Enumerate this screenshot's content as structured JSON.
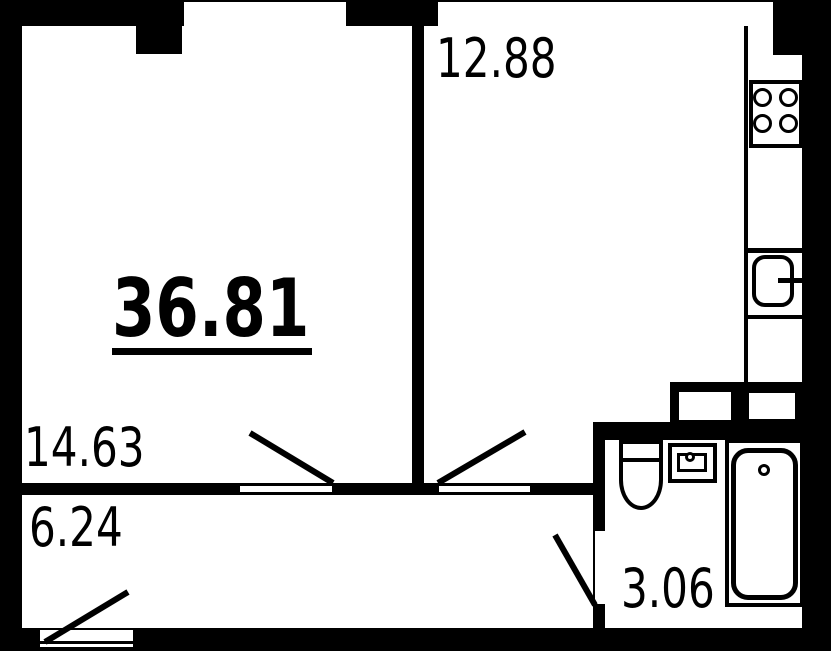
{
  "plan": {
    "total_area": "36.81",
    "rooms": [
      {
        "name": "living-room",
        "area": "14.63"
      },
      {
        "name": "kitchen",
        "area": "12.88"
      },
      {
        "name": "hallway",
        "area": "6.24"
      },
      {
        "name": "bathroom",
        "area": "3.06"
      }
    ],
    "colors": {
      "wall": "#000000",
      "floor": "#ffffff",
      "text": "#000000"
    },
    "icons": [
      "stove-burners-icon",
      "kitchen-sink-icon",
      "toilet-icon",
      "washbasin-icon",
      "bathtub-icon",
      "ventilation-duct-icon",
      "window-icon",
      "door-swing-icon"
    ]
  }
}
